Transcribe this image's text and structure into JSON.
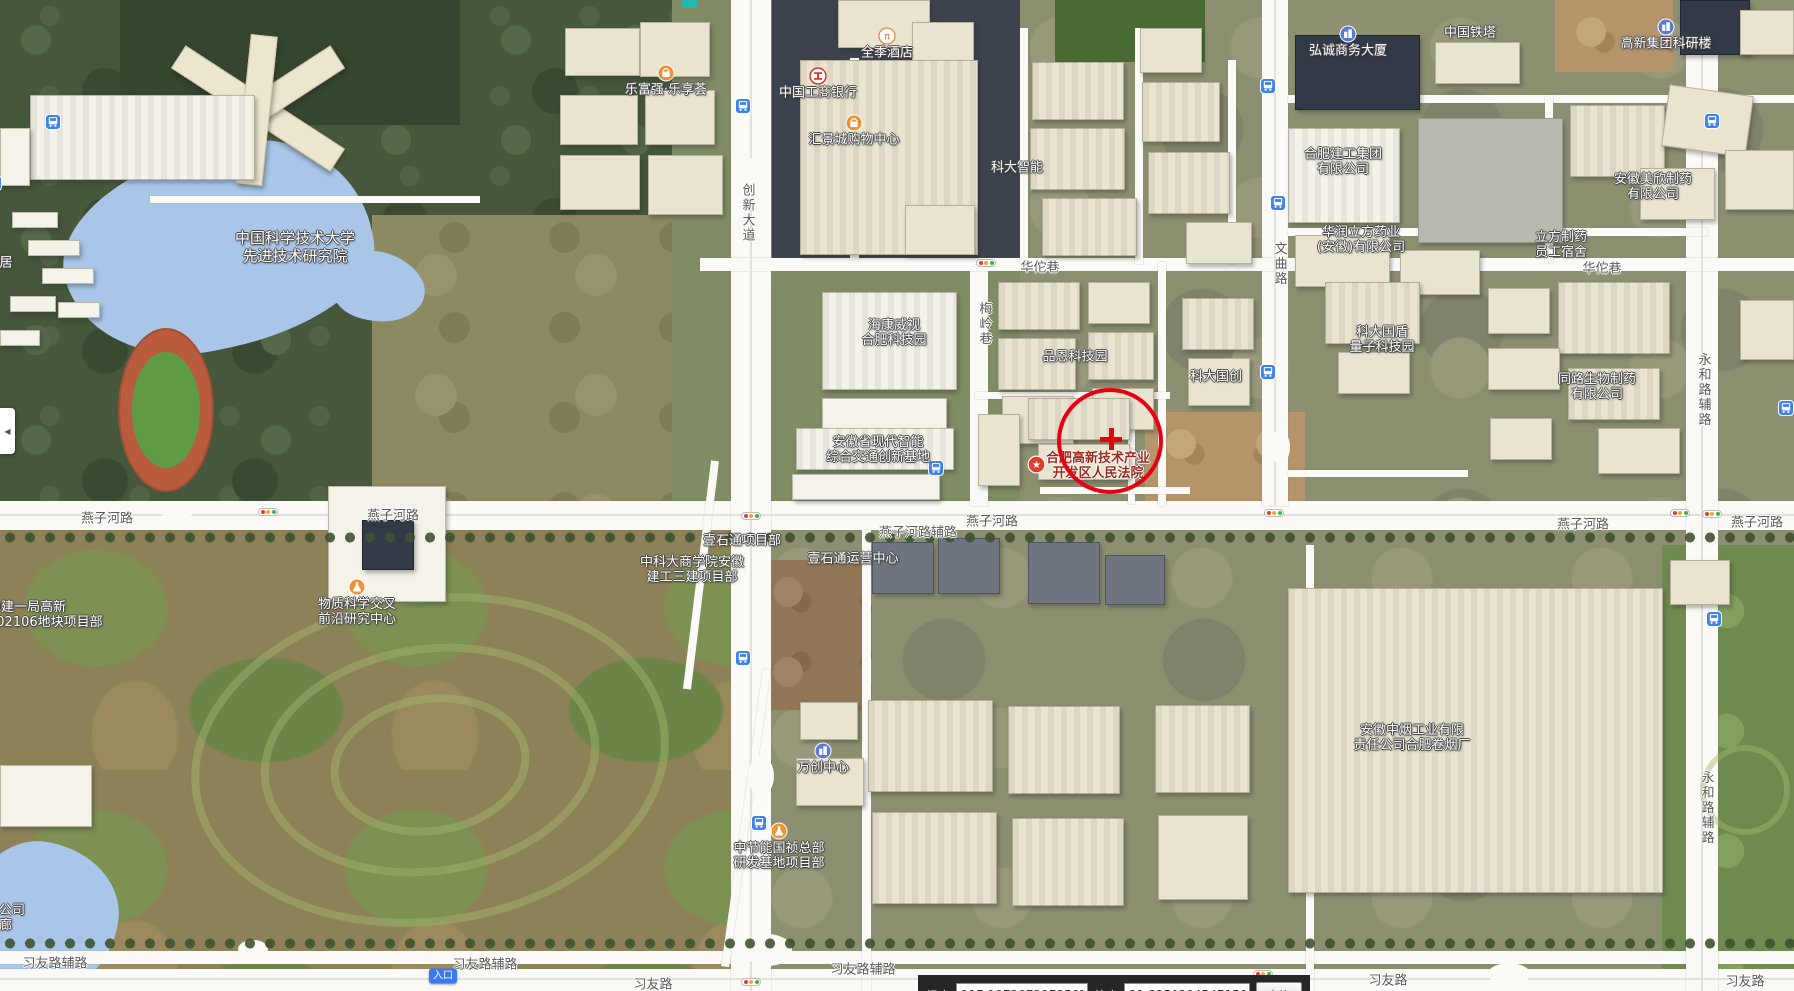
{
  "annotation": {
    "circle": {
      "cx": 1110,
      "cy": 441,
      "r": 53
    },
    "cross": {
      "x": 1111,
      "y": 439,
      "arm": 22,
      "thick": 5
    }
  },
  "statusbar": {
    "lng_label": "经度",
    "lng_value": "117.1973073073507",
    "lat_label": "纬度",
    "lat_value": "31.82503945471504",
    "query_label": "查询"
  },
  "panel_toggle": {
    "glyph": "◀"
  },
  "entrance_badge": {
    "label": "入口",
    "x": 443,
    "y": 976
  },
  "poi_labels": [
    {
      "name": "ustc-advanced-institute",
      "lines": [
        "中国科学技术大学",
        "先进技术研究院"
      ],
      "x": 295,
      "y": 247,
      "size": "big"
    },
    {
      "name": "lefuqiang-plaza",
      "lines": [
        "乐富强·乐享荟"
      ],
      "x": 666,
      "y": 90,
      "icon": "shopping-icon"
    },
    {
      "name": "icbc-bank",
      "lines": [
        "中国工商银行"
      ],
      "x": 818,
      "y": 93,
      "icon": "bank-icon"
    },
    {
      "name": "ji-hotel",
      "lines": [
        "全季酒店"
      ],
      "x": 887,
      "y": 53,
      "icon": "hotel-icon"
    },
    {
      "name": "huijingcheng-mall",
      "lines": [
        "汇景城购物中心"
      ],
      "x": 854,
      "y": 140,
      "icon": "shopping-icon"
    },
    {
      "name": "keda-zhineng",
      "lines": [
        "科大智能"
      ],
      "x": 1017,
      "y": 168
    },
    {
      "name": "hongcheng-tower",
      "lines": [
        "弘诚商务大厦"
      ],
      "x": 1348,
      "y": 51,
      "icon": "building-icon"
    },
    {
      "name": "china-tower",
      "lines": [
        "中国铁塔"
      ],
      "x": 1470,
      "y": 33
    },
    {
      "name": "gaoxin-research-building",
      "lines": [
        "高新集团科研楼"
      ],
      "x": 1666,
      "y": 44,
      "icon": "building-icon"
    },
    {
      "name": "hefei-construction-group",
      "lines": [
        "合肥建工集团",
        "有限公司"
      ],
      "x": 1343,
      "y": 162
    },
    {
      "name": "huarun-lifang-pharma",
      "lines": [
        "华润立方药业",
        "(安徽)有限公司"
      ],
      "x": 1361,
      "y": 240
    },
    {
      "name": "lifang-dormitory",
      "lines": [
        "立方制药",
        "员工宿舍"
      ],
      "x": 1561,
      "y": 245
    },
    {
      "name": "meixin-pharma",
      "lines": [
        "安徽美欣制药",
        "有限公司"
      ],
      "x": 1653,
      "y": 187
    },
    {
      "name": "hikvision-park",
      "lines": [
        "海康威视",
        "合肥科技园"
      ],
      "x": 894,
      "y": 333
    },
    {
      "name": "pinen-tech-park",
      "lines": [
        "品恩科技园"
      ],
      "x": 1075,
      "y": 357
    },
    {
      "name": "keda-guochuang",
      "lines": [
        "科大国创"
      ],
      "x": 1216,
      "y": 377
    },
    {
      "name": "guodun-quantum-park",
      "lines": [
        "科大国盾",
        "量子科技园"
      ],
      "x": 1382,
      "y": 340
    },
    {
      "name": "tonglu-biopharma",
      "lines": [
        "同路生物制药",
        "有限公司"
      ],
      "x": 1597,
      "y": 387
    },
    {
      "name": "smart-transport-base",
      "lines": [
        "安徽省现代智能",
        "综合交通创新基地"
      ],
      "x": 878,
      "y": 450
    },
    {
      "name": "hightech-court",
      "lines": [
        "合肥高新技术产业",
        "开发区人民法院"
      ],
      "x": 1098,
      "y": 466,
      "icon": "court-icon",
      "icon_dx": -62,
      "icon_dy": -2,
      "style": "court"
    },
    {
      "name": "yishitong-project",
      "lines": [
        "壹石通项目部"
      ],
      "x": 742,
      "y": 541
    },
    {
      "name": "yishitong-center",
      "lines": [
        "壹石通运营中心"
      ],
      "x": 853,
      "y": 559
    },
    {
      "name": "ustc-business-school-site",
      "lines": [
        "中科大商学院安徽",
        "建工三建项目部"
      ],
      "x": 692,
      "y": 570
    },
    {
      "name": "zhongjian-site",
      "lines": [
        "中建一局高新",
        "202106地块项目部"
      ],
      "x": -12,
      "y": 615,
      "align": "leftcut"
    },
    {
      "name": "matter-science-center",
      "lines": [
        "物质科学交叉",
        "前沿研究中心"
      ],
      "x": 357,
      "y": 612,
      "icon": "science-icon"
    },
    {
      "name": "tobacco-factory",
      "lines": [
        "安徽中烟工业有限",
        "责任公司合肥卷烟厂"
      ],
      "x": 1412,
      "y": 738
    },
    {
      "name": "wanchuang-center",
      "lines": [
        "万创中心"
      ],
      "x": 823,
      "y": 768,
      "icon": "building-icon"
    },
    {
      "name": "zhongjieneng-hq-site",
      "lines": [
        "中节能国祯总部",
        "研发基地项目部"
      ],
      "x": 779,
      "y": 856,
      "icon": "science-icon"
    },
    {
      "name": "pipe-gallery-partial",
      "lines": [
        "廊公司",
        "管廊"
      ],
      "x": -14,
      "y": 918,
      "align": "leftcut"
    },
    {
      "name": "ju-partial",
      "lines": [
        "居"
      ],
      "x": 6,
      "y": 263
    }
  ],
  "road_labels": [
    {
      "text": "燕子河路",
      "x": 107,
      "y": 517
    },
    {
      "text": "燕子河路",
      "x": 393,
      "y": 514
    },
    {
      "text": "燕子河路辅路",
      "x": 918,
      "y": 531
    },
    {
      "text": "燕子河路",
      "x": 992,
      "y": 520
    },
    {
      "text": "燕子河路",
      "x": 1583,
      "y": 523
    },
    {
      "text": "燕子河路",
      "x": 1757,
      "y": 521
    },
    {
      "text": "华佗巷",
      "x": 1040,
      "y": 266
    },
    {
      "text": "华佗巷",
      "x": 1602,
      "y": 267
    },
    {
      "text": "习友路辅路",
      "x": 55,
      "y": 962
    },
    {
      "text": "习友路辅路",
      "x": 485,
      "y": 963
    },
    {
      "text": "习友路辅路",
      "x": 863,
      "y": 968
    },
    {
      "text": "习友路",
      "x": 653,
      "y": 983
    },
    {
      "text": "习友路",
      "x": 1388,
      "y": 979
    },
    {
      "text": "习友路",
      "x": 1745,
      "y": 980
    },
    {
      "text": "创新大道",
      "x": 747,
      "y": 213,
      "vertical": true
    },
    {
      "text": "文曲路",
      "x": 1279,
      "y": 264,
      "vertical": true
    },
    {
      "text": "梅岭巷",
      "x": 984,
      "y": 324,
      "vertical": true
    },
    {
      "text": "永和路辅路",
      "x": 1703,
      "y": 390,
      "vertical": true
    },
    {
      "text": "永和路辅路",
      "x": 1706,
      "y": 808,
      "vertical": true
    }
  ],
  "bus_stops": [
    {
      "x": 53,
      "y": 122
    },
    {
      "x": -6,
      "y": 183
    },
    {
      "x": 743,
      "y": 106
    },
    {
      "x": 1268,
      "y": 86
    },
    {
      "x": 1278,
      "y": 203
    },
    {
      "x": 936,
      "y": 468
    },
    {
      "x": 743,
      "y": 658
    },
    {
      "x": 759,
      "y": 823
    },
    {
      "x": 1268,
      "y": 372
    },
    {
      "x": 1712,
      "y": 121
    },
    {
      "x": 1714,
      "y": 619
    },
    {
      "x": 1786,
      "y": 408
    }
  ],
  "traffic_lights": [
    {
      "x": 986,
      "y": 263
    },
    {
      "x": 268,
      "y": 512
    },
    {
      "x": 751,
      "y": 516
    },
    {
      "x": 1274,
      "y": 513
    },
    {
      "x": 1680,
      "y": 513
    },
    {
      "x": 1712,
      "y": 514
    },
    {
      "x": 751,
      "y": 982
    },
    {
      "x": 1263,
      "y": 974
    }
  ]
}
